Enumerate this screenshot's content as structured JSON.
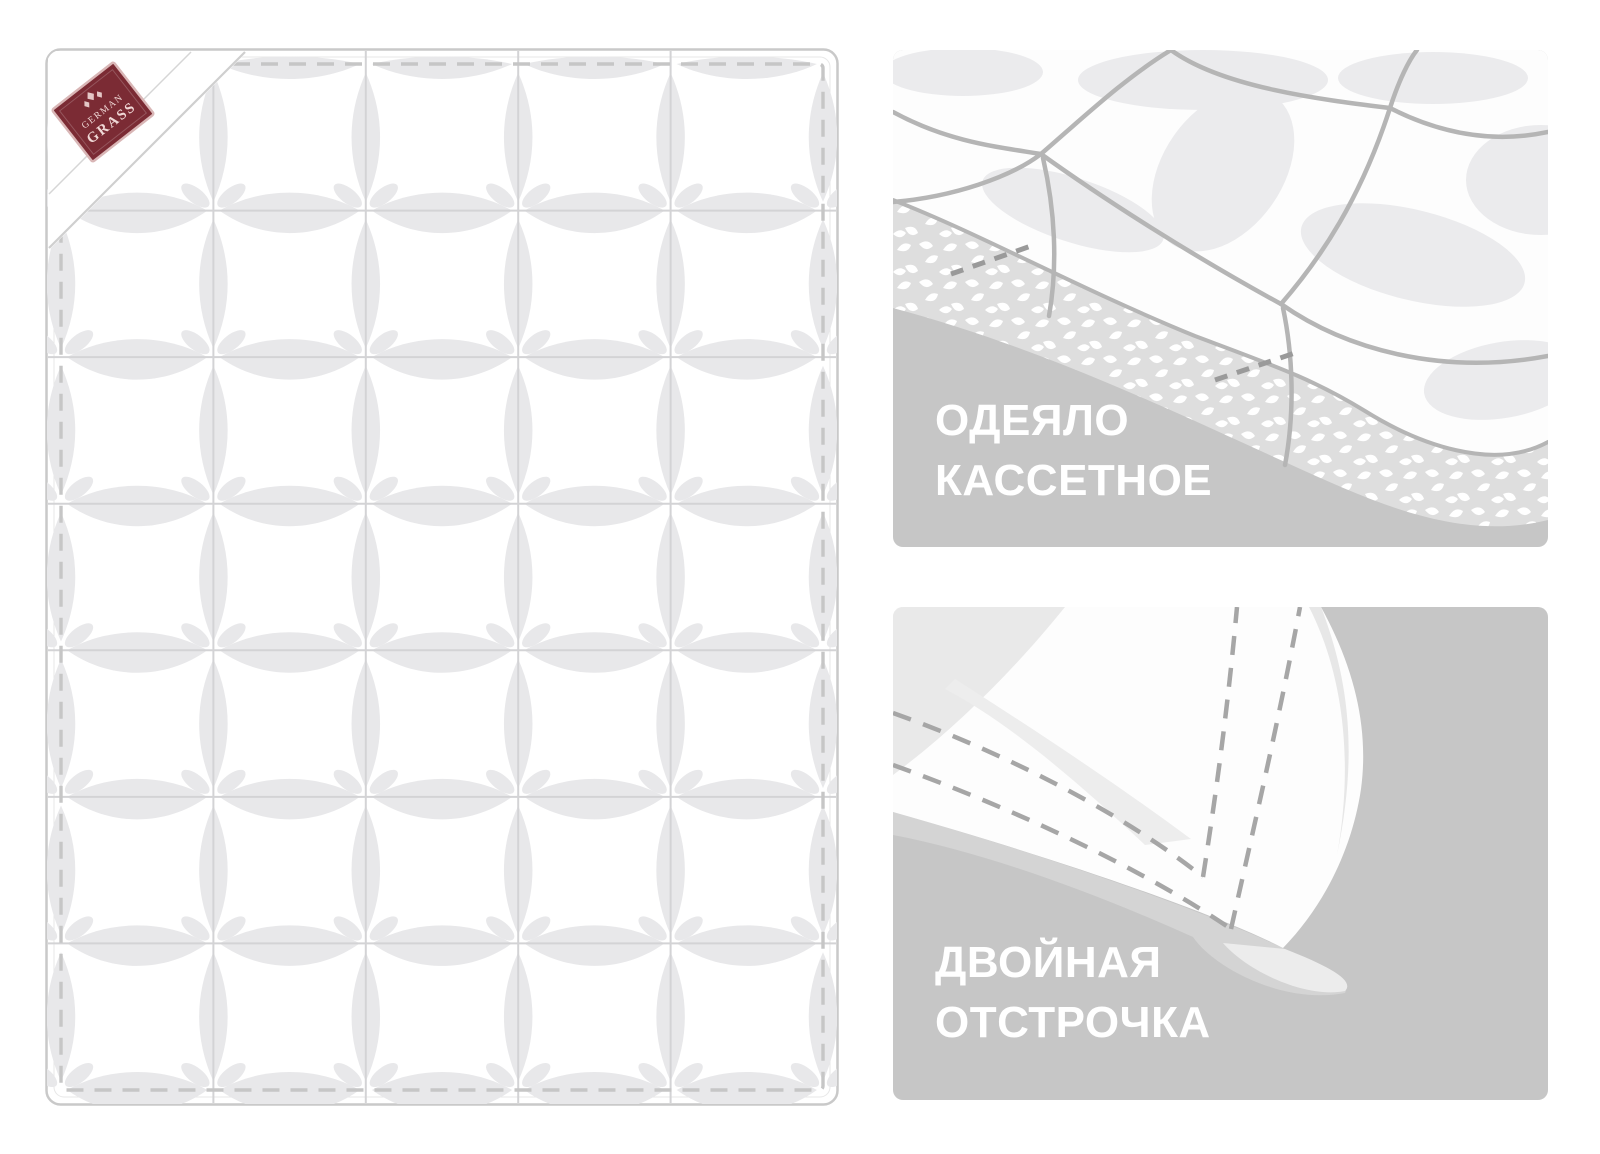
{
  "brand_label": {
    "line1": "GERMAN",
    "line2": "GRASS"
  },
  "quilt": {
    "rows": 7,
    "cols": 5
  },
  "panels": [
    {
      "caption_line1": "ОДЕЯЛО",
      "caption_line2": "КАССЕТНОЕ"
    },
    {
      "caption_line1": "ДВОЙНАЯ",
      "caption_line2": "ОТСТРОЧКА"
    }
  ],
  "colors": {
    "page_bg": "#ffffff",
    "quilt_fill": "#ffffff",
    "quilt_outline": "#c9c9c9",
    "seam": "#d3d3d5",
    "lens": "#e8e8ea",
    "stitch": "#c6c6c6",
    "fold_line": "#cfcfcf",
    "label_bg": "#7b2b34",
    "label_border": "#d9b6b6",
    "label_text": "#f0d8d6",
    "panel_bg": "#c6c6c6",
    "panel_art_line": "#b5b5b5",
    "caption_text": "#ffffff"
  }
}
